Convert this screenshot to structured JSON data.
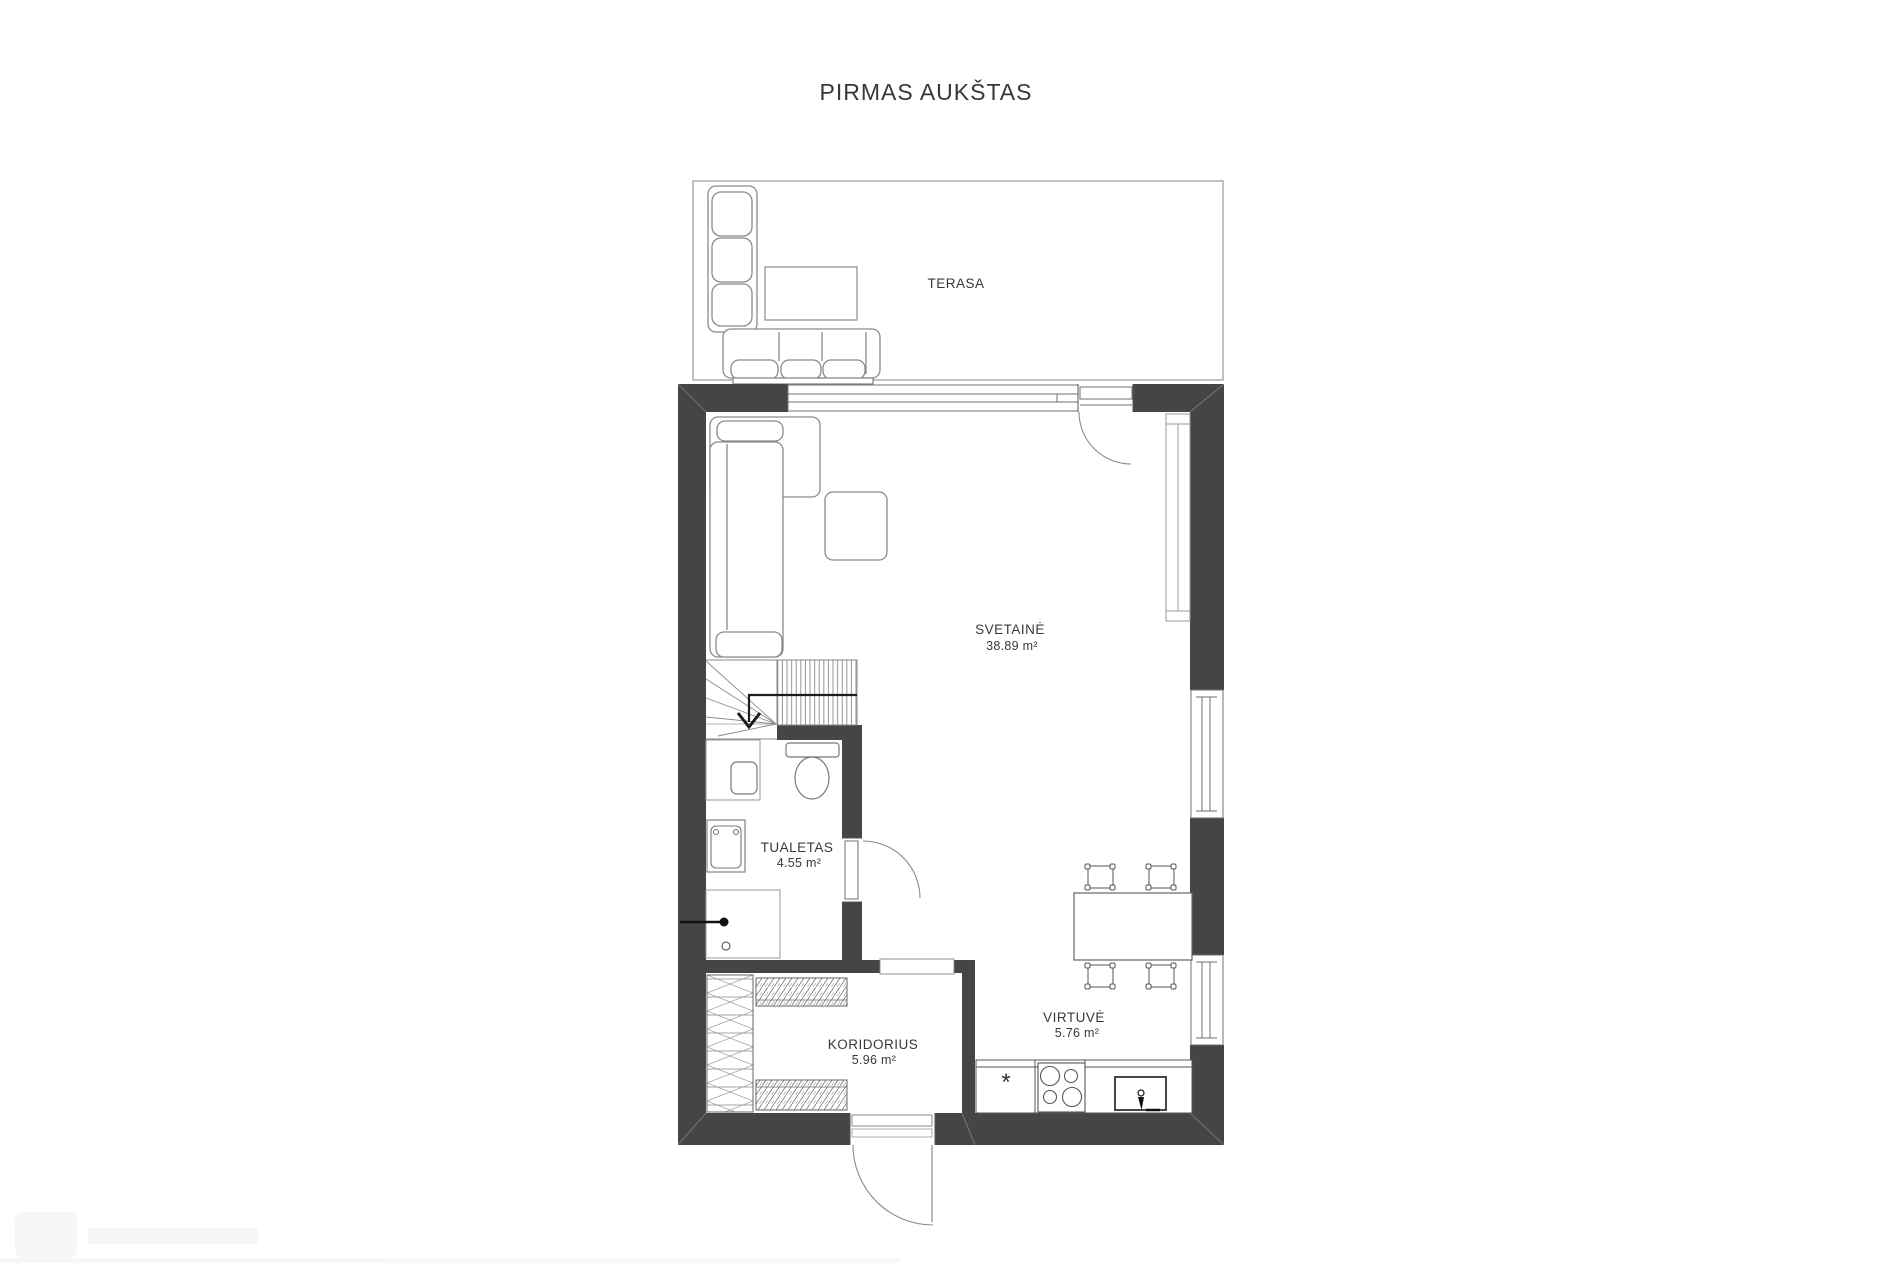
{
  "page": {
    "title": "PIRMAS AUKŠTAS"
  },
  "rooms": {
    "terasa": {
      "label": "TERASA"
    },
    "svetaine": {
      "label": "SVETAINĖ",
      "area": "38.89 m²"
    },
    "tualetas": {
      "label": "TUALETAS",
      "area": "4.55 m²"
    },
    "koridorius": {
      "label": "KORIDORIUS",
      "area": "5.96 m²"
    },
    "virtuve": {
      "label": "VIRTUVĖ",
      "area": "5.76 m²"
    }
  },
  "kitchen": {
    "appliance_mark": "*"
  },
  "colors": {
    "wall": "#454545",
    "furniture_line": "#8a8a8a",
    "fixture_line": "#777777",
    "text": "#383838",
    "background": "#ffffff"
  }
}
